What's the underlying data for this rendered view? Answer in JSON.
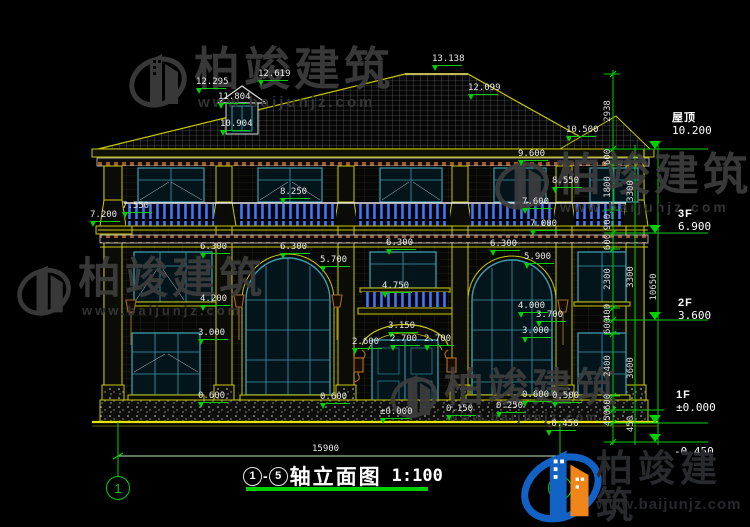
{
  "title": {
    "axis_from": "1",
    "dash": "-",
    "axis_to": "5",
    "name": "轴立面图",
    "scale": "1:100"
  },
  "overall_dim": "15900",
  "axis_markers": {
    "left": "1",
    "right": "5"
  },
  "watermark": {
    "brand": "柏竣建筑",
    "url": "www.baijunjz.com"
  },
  "colors": {
    "cad_yellow": "#c9c900",
    "cad_green": "#00cf00",
    "cad_teal": "#3d9daf",
    "baluster_blue": "#2a52be",
    "cornice_brown": "#a45a28",
    "logo_blue": "#1261c4",
    "logo_orange": "#f08519"
  },
  "levels": [
    {
      "name": "屋顶",
      "value": "10.200",
      "x": 672,
      "y": 112
    },
    {
      "name": "3F",
      "value": "6.900",
      "x": 678,
      "y": 208
    },
    {
      "name": "2F",
      "value": "3.600",
      "x": 678,
      "y": 297
    },
    {
      "name": "1F",
      "value": "±0.000",
      "x": 676,
      "y": 389
    },
    {
      "name": "",
      "value": "-0.450",
      "x": 674,
      "y": 446
    }
  ],
  "elevation_labels": [
    {
      "text": "13.138",
      "x": 432,
      "y": 55
    },
    {
      "text": "12.619",
      "x": 258,
      "y": 70
    },
    {
      "text": "12.295",
      "x": 196,
      "y": 78
    },
    {
      "text": "12.099",
      "x": 468,
      "y": 84
    },
    {
      "text": "11.804",
      "x": 218,
      "y": 93
    },
    {
      "text": "10.904",
      "x": 220,
      "y": 120
    },
    {
      "text": "10.500",
      "x": 566,
      "y": 126
    },
    {
      "text": "9.600",
      "x": 518,
      "y": 150
    },
    {
      "text": "8.550",
      "x": 552,
      "y": 177
    },
    {
      "text": "8.250",
      "x": 280,
      "y": 188
    },
    {
      "text": "7.600",
      "x": 522,
      "y": 198
    },
    {
      "text": "7.550",
      "x": 122,
      "y": 202
    },
    {
      "text": "7.200",
      "x": 90,
      "y": 211
    },
    {
      "text": "7.000",
      "x": 530,
      "y": 220
    },
    {
      "text": "6.300",
      "x": 200,
      "y": 243
    },
    {
      "text": "6.300",
      "x": 280,
      "y": 243
    },
    {
      "text": "6.300",
      "x": 386,
      "y": 239
    },
    {
      "text": "6.300",
      "x": 490,
      "y": 240
    },
    {
      "text": "5.900",
      "x": 524,
      "y": 253
    },
    {
      "text": "5.700",
      "x": 320,
      "y": 256
    },
    {
      "text": "4.750",
      "x": 382,
      "y": 282
    },
    {
      "text": "4.200",
      "x": 200,
      "y": 295
    },
    {
      "text": "4.000",
      "x": 518,
      "y": 302
    },
    {
      "text": "3.700",
      "x": 536,
      "y": 311
    },
    {
      "text": "3.150",
      "x": 388,
      "y": 322
    },
    {
      "text": "3.000",
      "x": 198,
      "y": 329
    },
    {
      "text": "3.000",
      "x": 522,
      "y": 327
    },
    {
      "text": "2.600",
      "x": 352,
      "y": 338
    },
    {
      "text": "2.700",
      "x": 390,
      "y": 335
    },
    {
      "text": "2.700",
      "x": 424,
      "y": 335
    },
    {
      "text": "0.600",
      "x": 198,
      "y": 392
    },
    {
      "text": "0.600",
      "x": 320,
      "y": 393
    },
    {
      "text": "0.600",
      "x": 522,
      "y": 391
    },
    {
      "text": "0.500",
      "x": 552,
      "y": 392
    },
    {
      "text": "0.250",
      "x": 496,
      "y": 402
    },
    {
      "text": "0.150",
      "x": 446,
      "y": 405
    },
    {
      "text": "±0.000",
      "x": 380,
      "y": 408
    },
    {
      "text": "-0.450",
      "x": 546,
      "y": 420
    }
  ],
  "vertical_dims": [
    {
      "text": "2938",
      "x": 608,
      "y": 111
    },
    {
      "text": "600",
      "x": 608,
      "y": 157
    },
    {
      "text": "1800",
      "x": 608,
      "y": 187
    },
    {
      "text": "900",
      "x": 608,
      "y": 222
    },
    {
      "text": "600",
      "x": 608,
      "y": 242
    },
    {
      "text": "2300",
      "x": 608,
      "y": 279
    },
    {
      "text": "400",
      "x": 608,
      "y": 312
    },
    {
      "text": "600",
      "x": 608,
      "y": 326
    },
    {
      "text": "2400",
      "x": 608,
      "y": 366
    },
    {
      "text": "600",
      "x": 608,
      "y": 402
    },
    {
      "text": "450",
      "x": 608,
      "y": 418
    },
    {
      "text": "3300",
      "x": 631,
      "y": 191
    },
    {
      "text": "3300",
      "x": 631,
      "y": 277
    },
    {
      "text": "3600",
      "x": 631,
      "y": 368
    },
    {
      "text": "450",
      "x": 631,
      "y": 424
    },
    {
      "text": "10650",
      "x": 654,
      "y": 287
    }
  ]
}
